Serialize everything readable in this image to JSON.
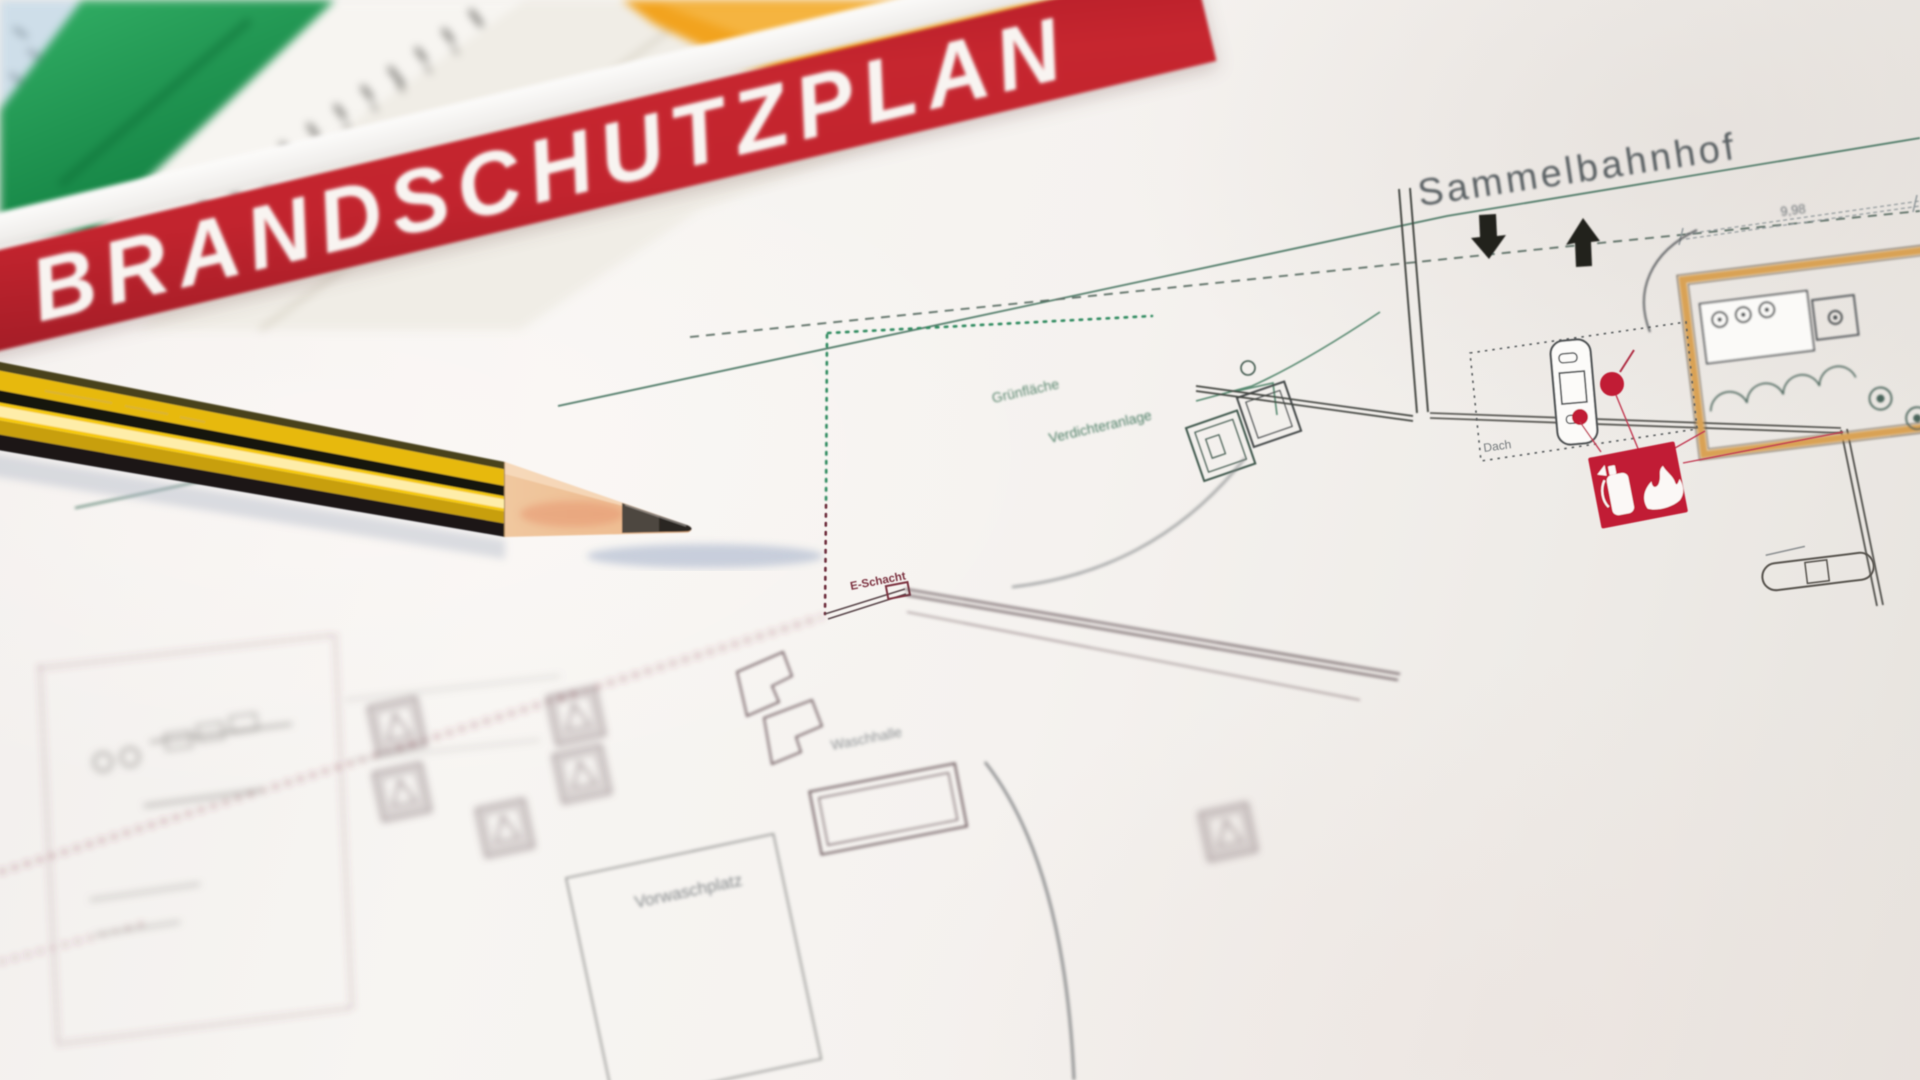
{
  "scene": {
    "description": "Close-up photograph of a German fire-protection site plan lying on a desk with drafting rulers, set squares and a sharpened yellow-black pencil",
    "colors": {
      "banner_red": "#c2242e",
      "paper_white": "#f5f2ef",
      "plan_green": "#55876e",
      "boundary_green_dotted": "#2f8a5f",
      "boundary_red_dotted": "#6e2f3c",
      "plan_line_dark": "#43464a",
      "symbol_red": "#c11f36",
      "tan_wall": "#d9a254",
      "pencil_yellow": "#f6c90f",
      "ruler_green": "#23a05a",
      "ruler_blue": "#cedee9",
      "set_square_orange": "#f2a31e"
    }
  },
  "banner": {
    "title": "BRANDSCHUTZPLAN"
  },
  "plan": {
    "labels": {
      "sammelbahnhof": "Sammelbahnhof",
      "dimension": "9,98",
      "gruenflaeche": "Grünfläche",
      "verdichteranlage": "Verdichteranlage",
      "dach": "Dach",
      "e_schacht": "E-Schacht",
      "vorwaschplatz": "Vorwaschplatz",
      "waschhalle": "Waschhalle"
    },
    "symbols": [
      {
        "name": "fire-extinguisher-icon",
        "color": "#c11f36"
      },
      {
        "name": "hydrant-cherry-symbol",
        "color": "#c11f36"
      },
      {
        "name": "entry-arrow-down",
        "color": "#23231f"
      },
      {
        "name": "exit-arrow-up",
        "color": "#23231f"
      },
      {
        "name": "roof-vent-shaft",
        "color": "#515557"
      },
      {
        "name": "machine-equipment-symbols",
        "color": "#7b6a6e"
      }
    ]
  },
  "objects": {
    "pencil": {
      "type": "sharpened office pencil",
      "body": "yellow with black stripes"
    },
    "rulers": [
      "pale-blue ruler",
      "green ruler",
      "white scale ruler with ticks"
    ],
    "set_squares": [
      "cream set square",
      "orange set square"
    ]
  }
}
